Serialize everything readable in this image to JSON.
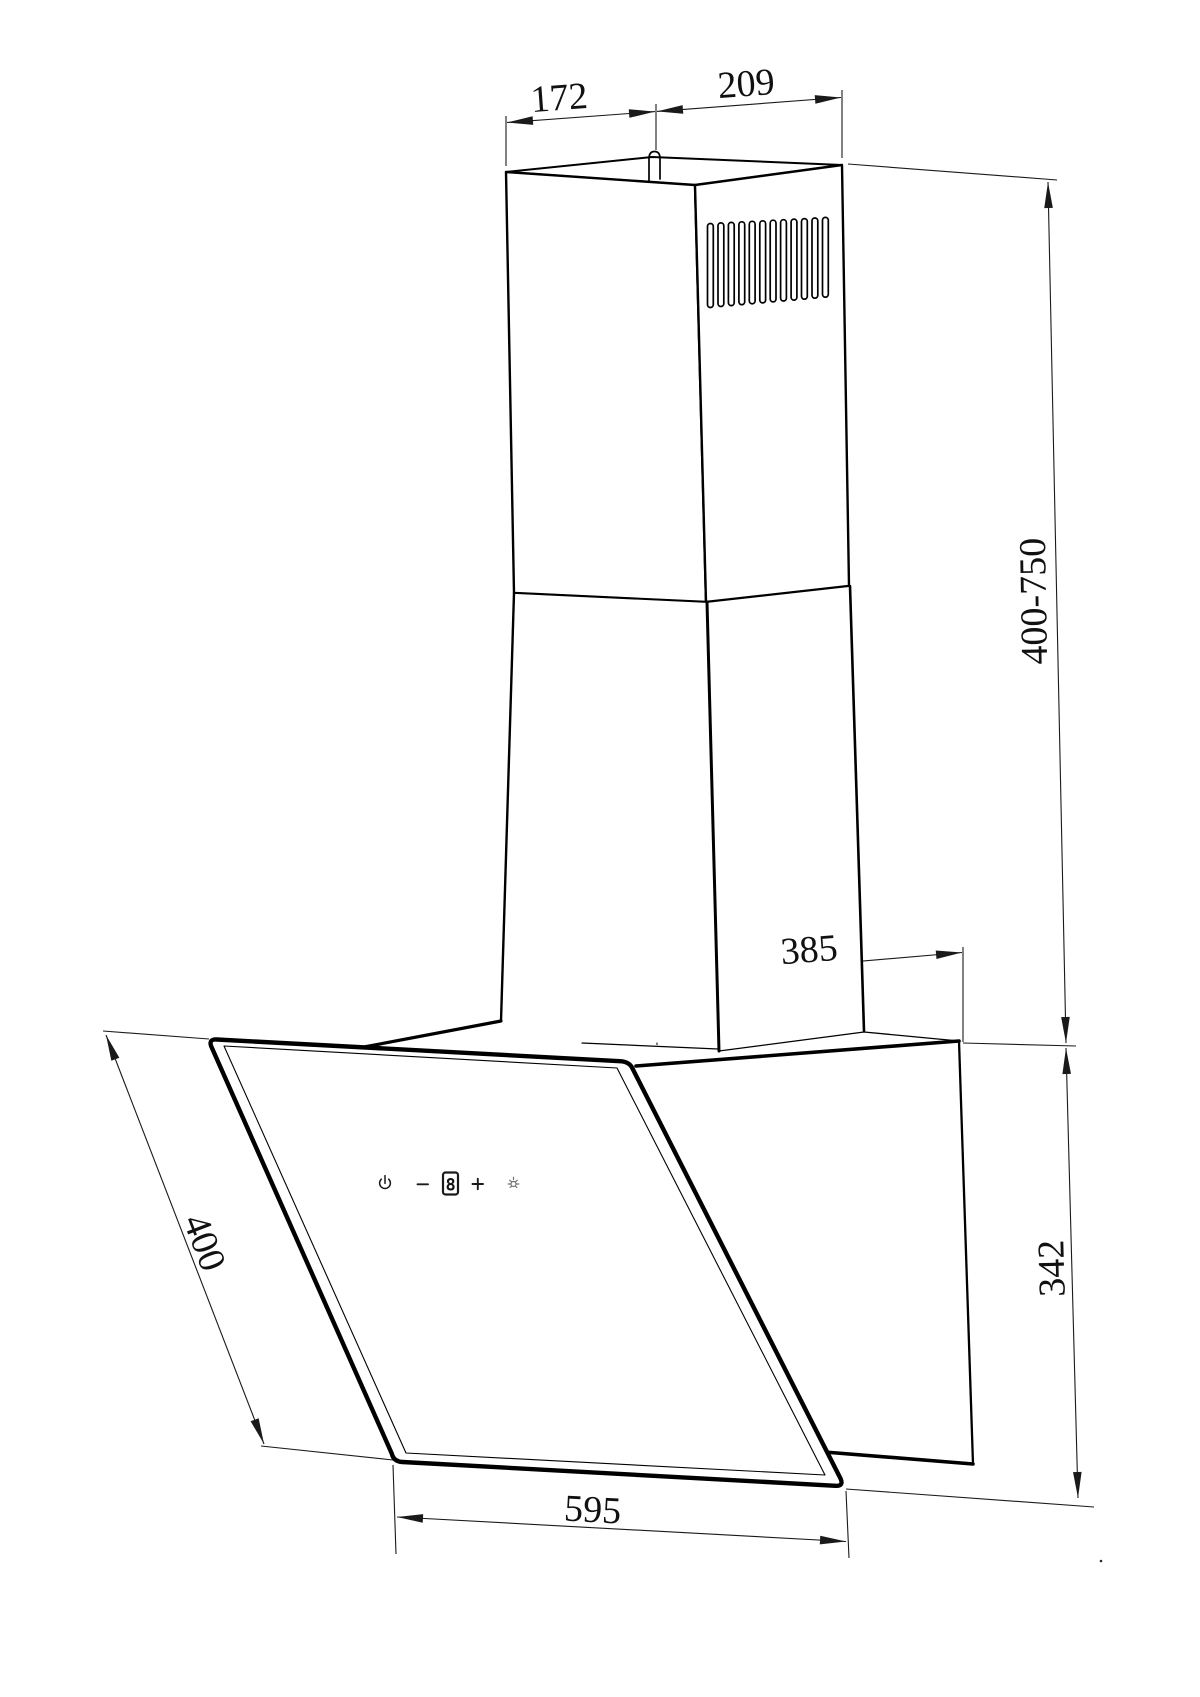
{
  "drawing": {
    "dimensions": {
      "chimney_top_width": "172",
      "chimney_top_depth": "209",
      "chimney_height_range": "400-750",
      "chimney_base_depth": "385",
      "rear_panel_height": "342",
      "glass_front_depth": "400",
      "hood_width": "595"
    },
    "control_panel": {
      "display_value": "8",
      "icons": [
        "power-icon",
        "minus-icon",
        "speed-display",
        "plus-icon",
        "light-icon"
      ]
    },
    "vent_slot_count": 12,
    "colors": {
      "line_color": "#000000",
      "dimension_color": "#1a1a1a",
      "light_icon_color": "#6e6e6e",
      "background": "#ffffff"
    }
  }
}
